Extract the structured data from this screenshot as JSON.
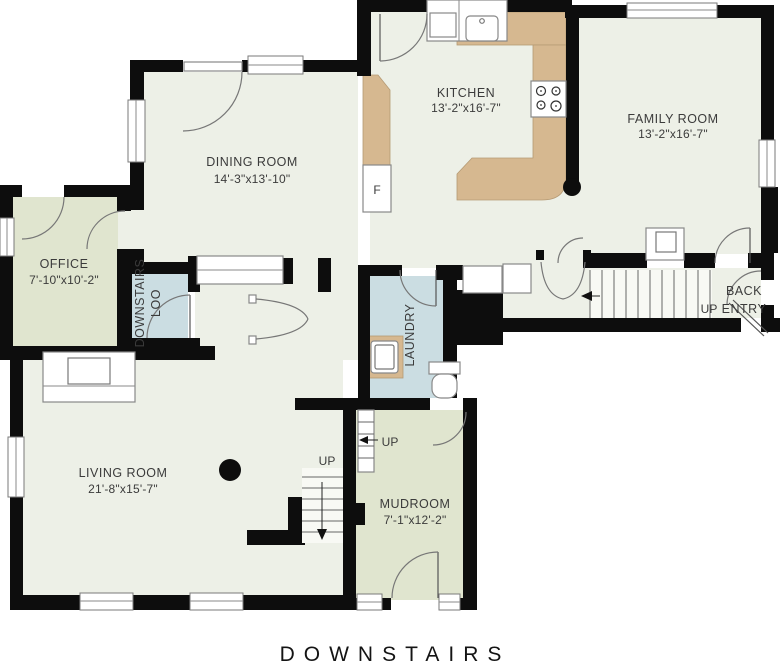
{
  "title": "DOWNSTAIRS",
  "rooms": {
    "kitchen": {
      "name": "KITCHEN",
      "dims": "13'-2\"x16'-7\""
    },
    "family_room": {
      "name": "FAMILY ROOM",
      "dims": "13'-2\"x16'-7\""
    },
    "dining_room": {
      "name": "DINING ROOM",
      "dims": "14'-3\"x13'-10\""
    },
    "office": {
      "name": "OFFICE",
      "dims": "7'-10\"x10'-2\""
    },
    "downstairs_loo": {
      "line1": "DOWNSTAIRS",
      "line2": "LOO"
    },
    "laundry": {
      "name": "LAUNDRY"
    },
    "back_entry": {
      "line1": "BACK",
      "line2": "ENTRY"
    },
    "living_room": {
      "name": "LIVING ROOM",
      "dims": "21'-8\"x15'-7\""
    },
    "mudroom": {
      "name": "MUDROOM",
      "dims": "7'-1\"x12'-2\""
    }
  },
  "labels": {
    "up": "UP",
    "fridge": "F"
  },
  "colors": {
    "floor": "#edf0e7",
    "accent_green": "#e0e5cf",
    "accent_blue": "#cbdde2",
    "counter": "#d6b890",
    "wall": "#0d0d0d"
  }
}
